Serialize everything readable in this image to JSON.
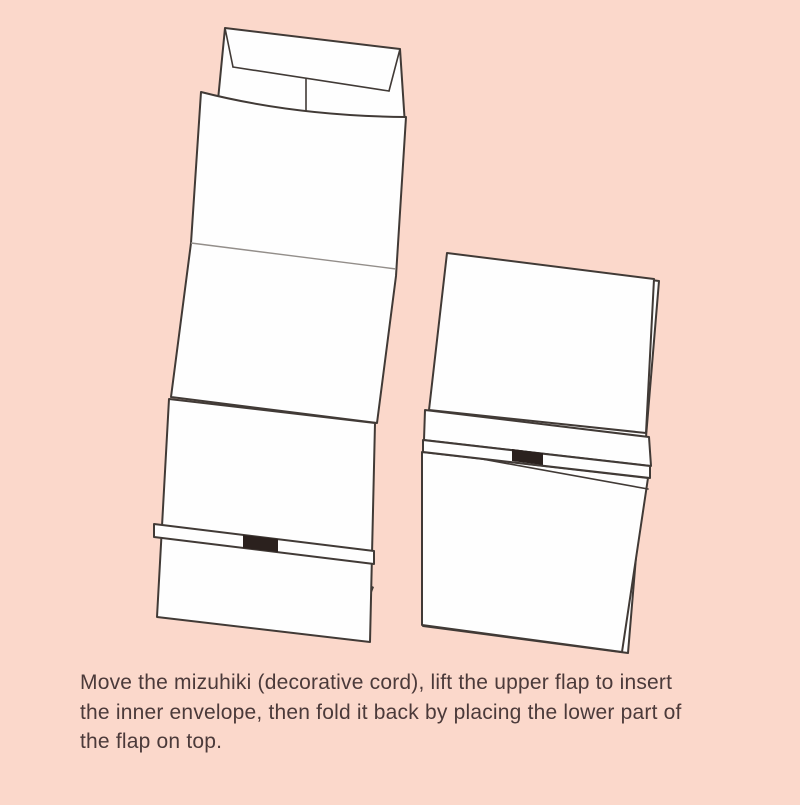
{
  "colors": {
    "bg": "#fbd8cb",
    "ink": "#413a36",
    "paper": "#fefefe",
    "fold": "#938e8a",
    "knot": "#2b211e",
    "text": "#4b3a3a"
  },
  "caption": {
    "line1": "Move the mizuhiki (decorative cord), lift the upper flap to insert",
    "line2": "the inner envelope, then fold it back by placing the lower part of",
    "line3": "the flap on top."
  },
  "illustration": {
    "description": "Two-step envelope folding diagram",
    "elements": {
      "left_figure": "wrapper with inner envelope inserted at top, mizuhiki band over lower flap",
      "right_figure": "folded envelope with flap edge strip and mizuhiki band"
    }
  }
}
